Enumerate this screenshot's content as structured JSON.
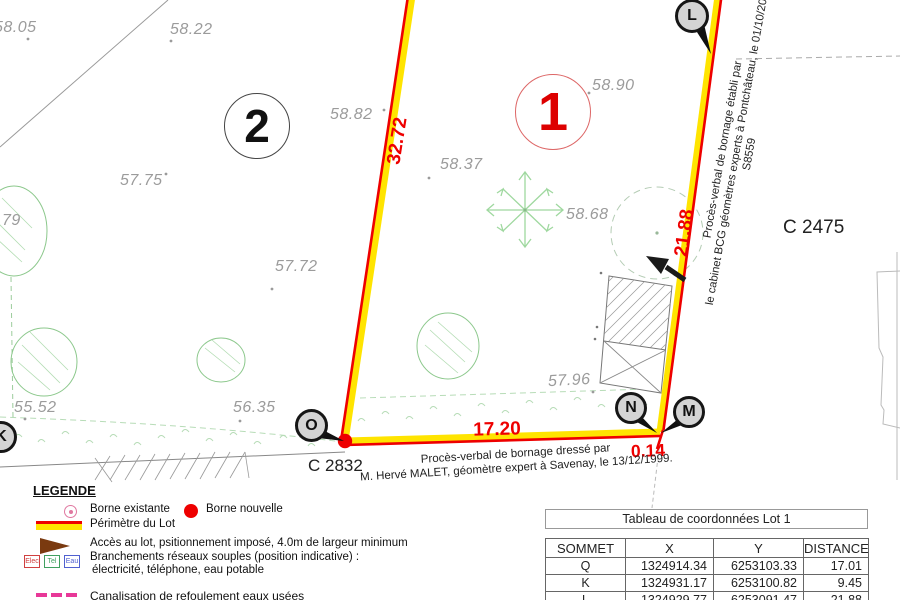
{
  "plan": {
    "lots": [
      {
        "number": "2"
      },
      {
        "number": "1"
      }
    ],
    "parcel_ids": {
      "bottom": "C 2832",
      "right": "C 2475"
    },
    "measurements": {
      "left_side": "32.72",
      "right_side": "21.88",
      "bottom_side": "17.20",
      "offset": "0.14"
    },
    "elevations": [
      "58.05",
      "58.22",
      "58.82",
      "58.90",
      "57.75",
      "58.37",
      "58.68",
      ".79",
      "57.72",
      "57.96",
      "55.52",
      "56.35"
    ],
    "survey_points": {
      "L": "L",
      "O": "O",
      "N": "N",
      "M": "M",
      "K": "K"
    },
    "annotations": {
      "right_line1": "Procès-verbal de bornage établi par",
      "right_line2": "le cabinet BCG géomètres experts à Pontchâteau, le 01/10/20",
      "right_line3": "S8559",
      "bottom_line1": "Procès-verbal de bornage dressé par",
      "bottom_line2": "M. Hervé MALET, géomètre expert à Savenay, le 13/12/1999."
    }
  },
  "legend": {
    "title": "LEGENDE",
    "borne_existante": "Borne existante",
    "borne_nouvelle": "Borne nouvelle",
    "perimetre": "Périmètre du Lot",
    "acces": "Accès au lot, psitionnement imposé, 4.0m de largeur minimum",
    "branchements_line1": "Branchements réseaux souples (position indicative) :",
    "branchements_line2": "électricité, téléphone, eau potable",
    "network_boxes": [
      "Elec",
      "Tel",
      "Eau"
    ],
    "canalisation": "Canalisation de refoulement eaux usées"
  },
  "table": {
    "title": "Tableau de coordonnées Lot 1",
    "headers": [
      "SOMMET",
      "X",
      "Y",
      "DISTANCE"
    ],
    "rows": [
      [
        "Q",
        "1324914.34",
        "6253103.33",
        "17.01"
      ],
      [
        "K",
        "1324931.17",
        "6253100.82",
        "9.45"
      ],
      [
        "L",
        "1324929.77",
        "6253091.47",
        "21.88"
      ]
    ]
  },
  "colors": {
    "perimeter_yellow": "#ffe400",
    "perimeter_red": "#ee0000",
    "vegetation_green": "#8cc88c",
    "elevation_gray": "#9b9b9b",
    "lot1_red": "#dd0000"
  }
}
